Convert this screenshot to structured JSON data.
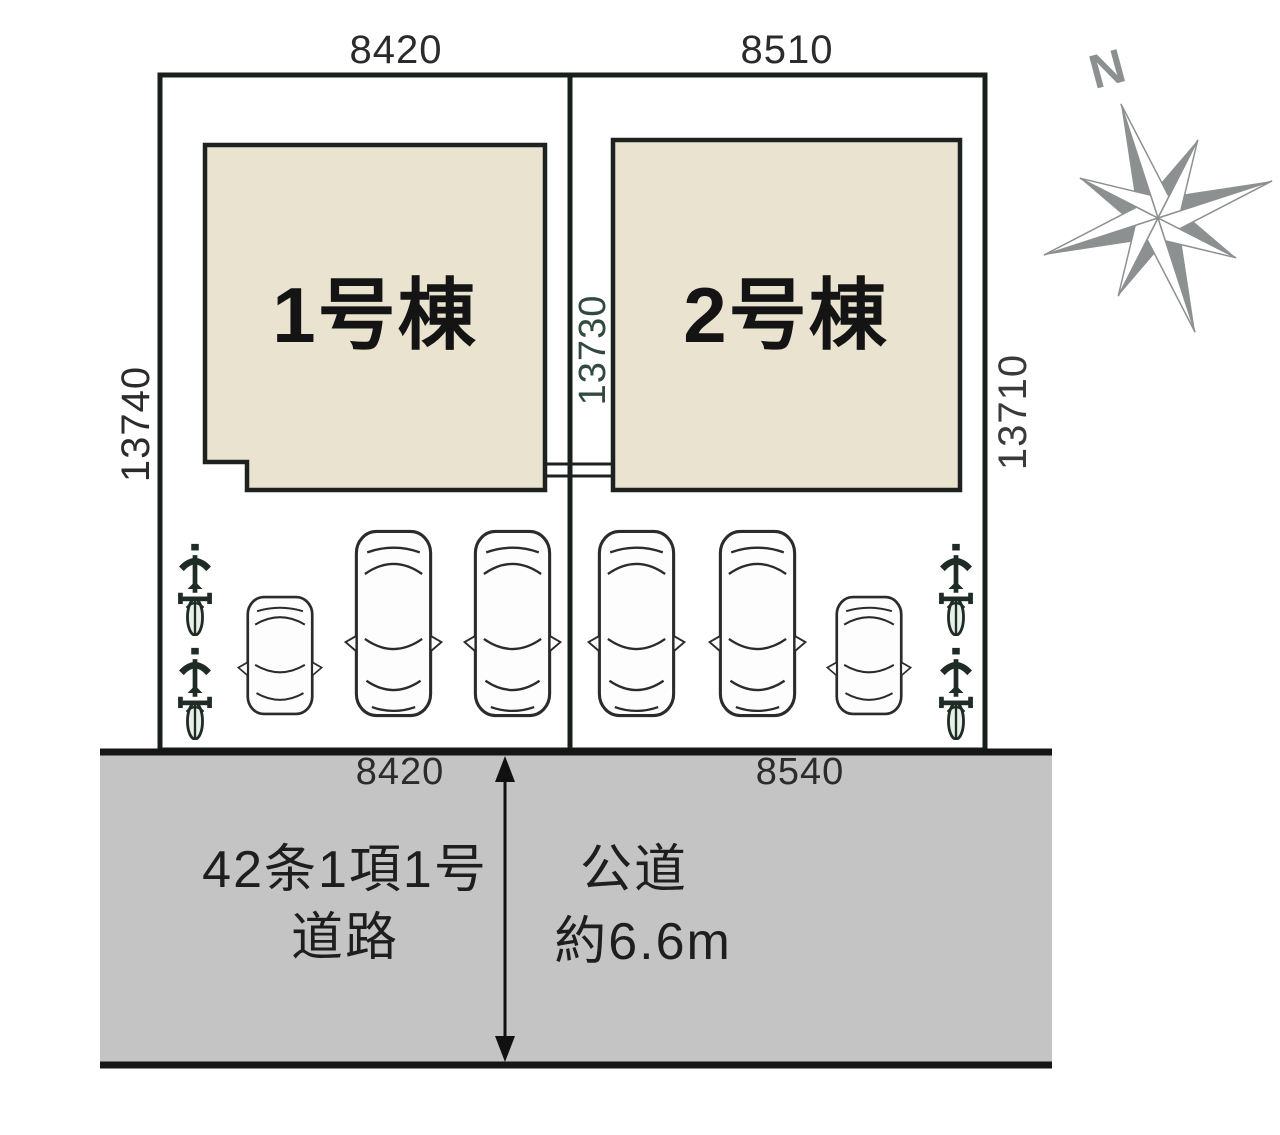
{
  "site_plan": {
    "lot1": {
      "top_width": "8420",
      "left_depth": "13740",
      "building_label": "1号棟",
      "frontage": "8420"
    },
    "lot2": {
      "top_width": "8510",
      "center_depth": "13730",
      "right_depth": "13710",
      "building_label": "2号棟",
      "frontage": "8540"
    },
    "road": {
      "classification_line1": "42条1項1号",
      "classification_line2": "道路",
      "type": "公道",
      "width": "約6.6m"
    },
    "compass": {
      "north_label": "N"
    },
    "icons": {
      "compass": "compass-rose-icon",
      "car": "car-top-view-icon",
      "bicycle": "bicycle-front-icon",
      "arrow": "road-width-arrow"
    },
    "colors": {
      "lot_green": "#a4cbba",
      "building_beige": "#eae3d0",
      "road_gray": "#c4c4c4",
      "outline_dark": "#17201b",
      "compass_gray": "#8d9091",
      "depth_text_green": "#32493e"
    }
  }
}
